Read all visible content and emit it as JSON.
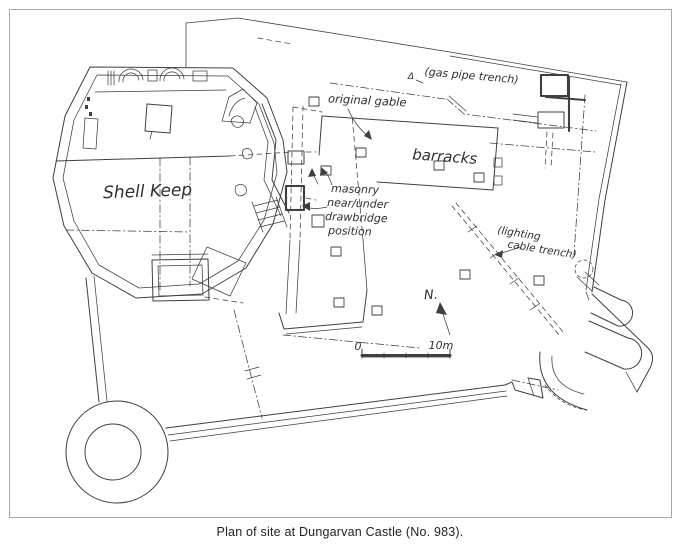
{
  "figure": {
    "caption": "Plan of site at Dungarvan Castle (No. 983)."
  },
  "colors": {
    "ink": "#3f3f3f",
    "paper": "#ffffff",
    "frame_border": "#a8a8a8",
    "caption_text": "#1f1f1f"
  },
  "plan": {
    "labels": {
      "shell_keep": "Shell Keep",
      "barracks": "barracks",
      "original_gable": "original gable",
      "gas_pipe_marker": "Δ",
      "gas_pipe_trench": "(gas pipe trench)",
      "masonry_line1": "masonry",
      "masonry_line2": "near/under",
      "masonry_line3": "drawbridge",
      "masonry_line4": "position",
      "lighting_trench_line1": "(lighting",
      "lighting_trench_line2": "cable trench)",
      "north": "N.",
      "scale_zero": "0",
      "scale_ten_m": "10m"
    }
  }
}
